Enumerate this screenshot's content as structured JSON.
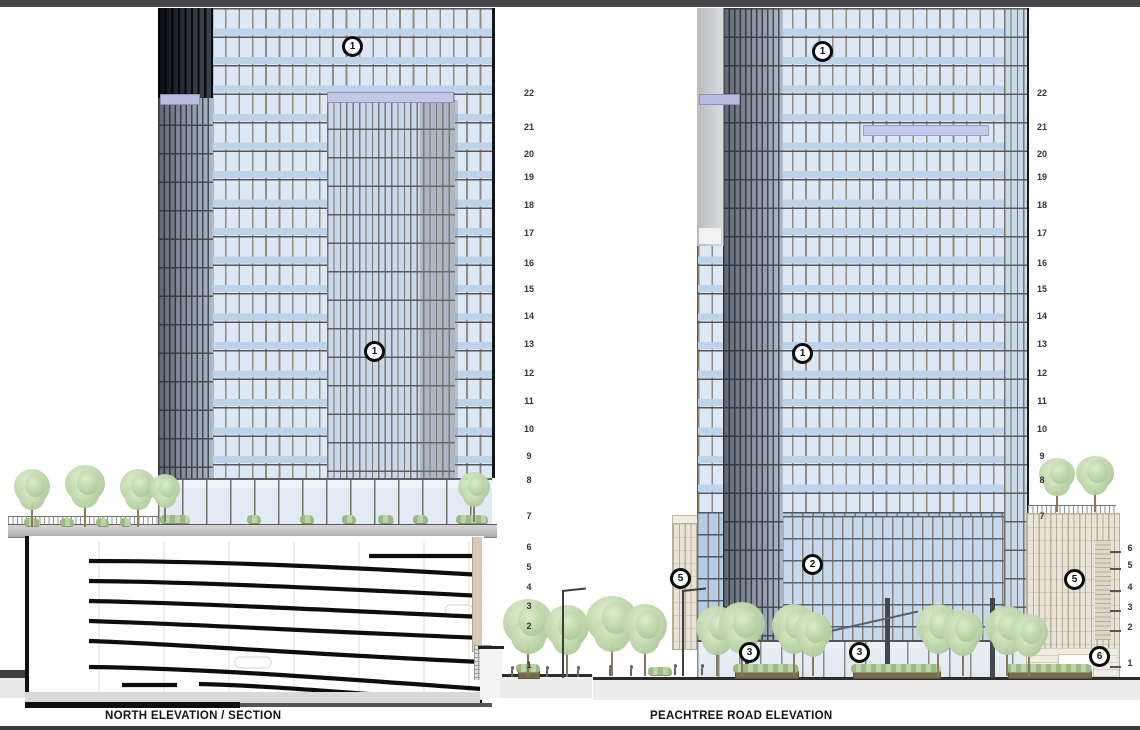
{
  "titles": {
    "north": "NORTH ELEVATION / SECTION",
    "peachtree": "PEACHTREE ROAD ELEVATION"
  },
  "floor_scales": [
    {
      "name": "north-tower-levels",
      "x": 529,
      "ticks": false,
      "labels": [
        {
          "t": "22",
          "y": 93
        },
        {
          "t": "21",
          "y": 127
        },
        {
          "t": "20",
          "y": 154
        },
        {
          "t": "19",
          "y": 177
        },
        {
          "t": "18",
          "y": 205
        },
        {
          "t": "17",
          "y": 233
        },
        {
          "t": "16",
          "y": 263
        },
        {
          "t": "15",
          "y": 289
        },
        {
          "t": "14",
          "y": 316
        },
        {
          "t": "13",
          "y": 344
        },
        {
          "t": "12",
          "y": 373
        },
        {
          "t": "11",
          "y": 401
        },
        {
          "t": "10",
          "y": 429
        },
        {
          "t": "9",
          "y": 456
        },
        {
          "t": "8",
          "y": 480
        },
        {
          "t": "7",
          "y": 516
        },
        {
          "t": "6",
          "y": 547
        },
        {
          "t": "5",
          "y": 567
        },
        {
          "t": "4",
          "y": 587
        },
        {
          "t": "3",
          "y": 606
        },
        {
          "t": "2",
          "y": 626
        },
        {
          "t": "1",
          "y": 665
        }
      ]
    },
    {
      "name": "peachtree-tower-levels",
      "x": 1042,
      "ticks": false,
      "labels": [
        {
          "t": "22",
          "y": 93
        },
        {
          "t": "21",
          "y": 127
        },
        {
          "t": "20",
          "y": 154
        },
        {
          "t": "19",
          "y": 177
        },
        {
          "t": "18",
          "y": 205
        },
        {
          "t": "17",
          "y": 233
        },
        {
          "t": "16",
          "y": 263
        },
        {
          "t": "15",
          "y": 289
        },
        {
          "t": "14",
          "y": 316
        },
        {
          "t": "13",
          "y": 344
        },
        {
          "t": "12",
          "y": 373
        },
        {
          "t": "11",
          "y": 401
        },
        {
          "t": "10",
          "y": 429
        },
        {
          "t": "9",
          "y": 456
        },
        {
          "t": "8",
          "y": 480
        },
        {
          "t": "7",
          "y": 516
        }
      ]
    },
    {
      "name": "peachtree-podium-levels",
      "x": 1130,
      "ticks": true,
      "labels": [
        {
          "t": "6",
          "y": 548
        },
        {
          "t": "5",
          "y": 565
        },
        {
          "t": "4",
          "y": 587
        },
        {
          "t": "3",
          "y": 607
        },
        {
          "t": "2",
          "y": 627
        },
        {
          "t": "1",
          "y": 663
        }
      ]
    }
  ],
  "callouts": [
    {
      "label": "1",
      "x": 353,
      "y": 47,
      "drawing": "north"
    },
    {
      "label": "1",
      "x": 375,
      "y": 352,
      "drawing": "north"
    },
    {
      "label": "1",
      "x": 823,
      "y": 52,
      "drawing": "peachtree"
    },
    {
      "label": "1",
      "x": 803,
      "y": 354,
      "drawing": "peachtree"
    },
    {
      "label": "2",
      "x": 813,
      "y": 565,
      "drawing": "peachtree"
    },
    {
      "label": "5",
      "x": 681,
      "y": 579,
      "drawing": "peachtree"
    },
    {
      "label": "5",
      "x": 1075,
      "y": 580,
      "drawing": "peachtree"
    },
    {
      "label": "3",
      "x": 750,
      "y": 653,
      "drawing": "peachtree"
    },
    {
      "label": "3",
      "x": 860,
      "y": 653,
      "drawing": "peachtree"
    },
    {
      "label": "6",
      "x": 1100,
      "y": 657,
      "drawing": "peachtree"
    }
  ],
  "colors": {
    "top_bar": "#46464a",
    "glass_light": "#dce8f5",
    "glass_spandrel": "#bdd3eb",
    "mullion_tan": "#948c7a",
    "lavender_band": "#b8bedd",
    "podium_beige": "#e9e4d7",
    "tree_green": "#b7d1a2",
    "line_black": "#111111",
    "ground_gray": "#ededed"
  }
}
